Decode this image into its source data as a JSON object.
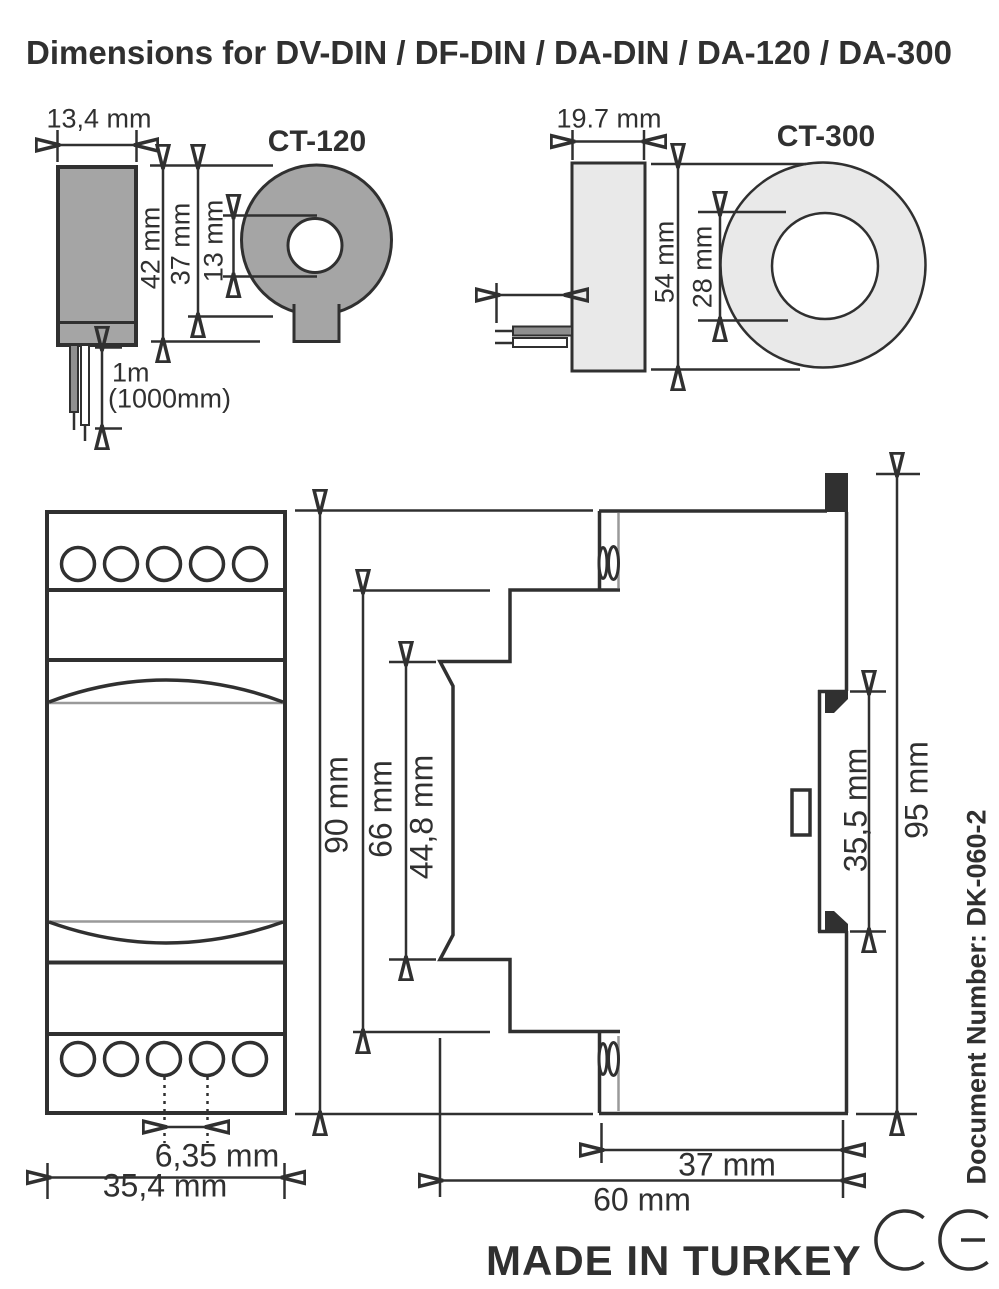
{
  "title": "Dimensions for DV-DIN / DF-DIN / DA-DIN / DA-120 / DA-300",
  "ct120": {
    "label": "CT-120",
    "width": "13,4 mm",
    "height": "42 mm",
    "body_height": "37 mm",
    "hole_diameter": "13 mm",
    "cable_length": "1m",
    "cable_length_alt": "(1000mm)"
  },
  "ct300": {
    "label": "CT-300",
    "width": "19.7 mm",
    "height": "54 mm",
    "hole_diameter": "28 mm"
  },
  "din_module": {
    "height": "90 mm",
    "mid_height": "66 mm",
    "front_height": "44,8 mm",
    "terminal_pitch": "6,35 mm",
    "width": "35,4 mm",
    "rear_depth": "37 mm",
    "depth": "60 mm",
    "rail_cutout": "35,5 mm",
    "total_height": "95 mm"
  },
  "footer": {
    "origin": "MADE IN TURKEY",
    "document_number": "Document Number: DK-060-2",
    "ce_mark": "CE"
  },
  "colors": {
    "line": "#303030",
    "ct120_fill": "#a5a5a5",
    "ct300_fill": "#e9e9e9",
    "wire_fill": "#8f8f8f",
    "light_line": "#9a9a9a",
    "background": "#ffffff"
  }
}
